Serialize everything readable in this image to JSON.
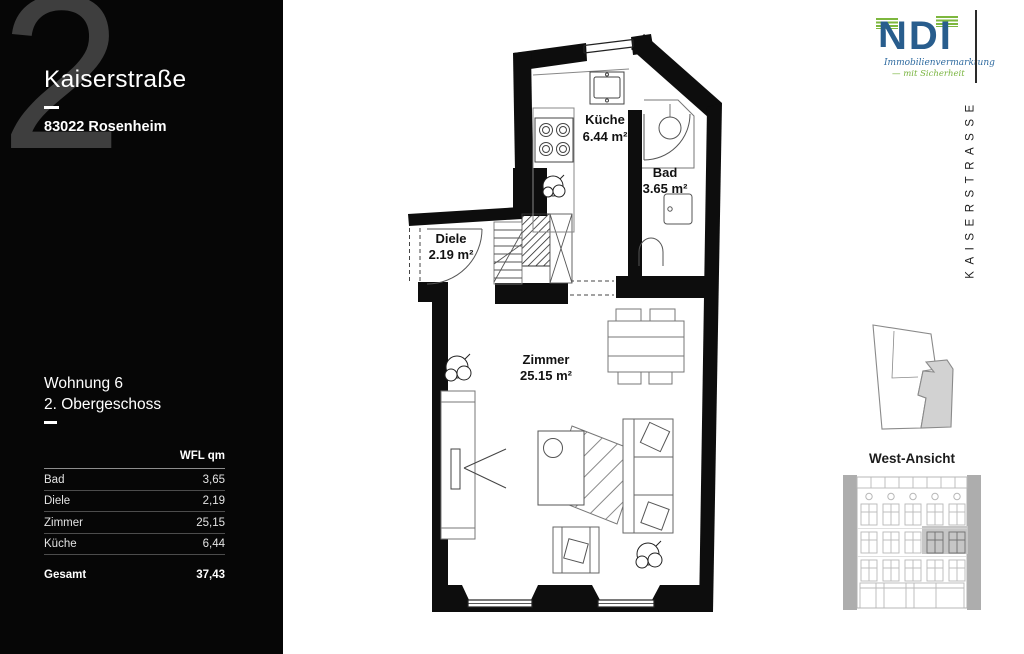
{
  "panel": {
    "big_number": "2",
    "street": "Kaiserstraße",
    "city": "83022 Rosenheim",
    "unit": "Wohnung 6",
    "floor": "2. Obergeschoss",
    "table": {
      "header": "WFL qm",
      "rows": [
        {
          "label": "Bad",
          "value": "3,65"
        },
        {
          "label": "Diele",
          "value": "2,19"
        },
        {
          "label": "Zimmer",
          "value": "25,15"
        },
        {
          "label": "Küche",
          "value": "6,44"
        }
      ],
      "total_label": "Gesamt",
      "total_value": "37,43"
    }
  },
  "plan": {
    "rooms": [
      {
        "name": "Küche",
        "area": "6.44 m²"
      },
      {
        "name": "Bad",
        "area": "3.65 m²"
      },
      {
        "name": "Diele",
        "area": "2.19 m²"
      },
      {
        "name": "Zimmer",
        "area": "25.15 m²"
      }
    ]
  },
  "logo": {
    "text": "NDI",
    "tagline_line1": "Immobilienvermarktung",
    "tagline_line2": "— mit Sicherheit",
    "color_blue": "#285d8d",
    "color_green": "#7db73e"
  },
  "right_margin": {
    "street_vertical": "KAISERSTRASSE"
  },
  "elevation": {
    "title": "West-Ansicht"
  },
  "colors": {
    "panel_bg": "#060606",
    "wall": "#0d0d0d",
    "elevation_gray": "#b0b0b0",
    "highlight": "#c6c6c6"
  }
}
